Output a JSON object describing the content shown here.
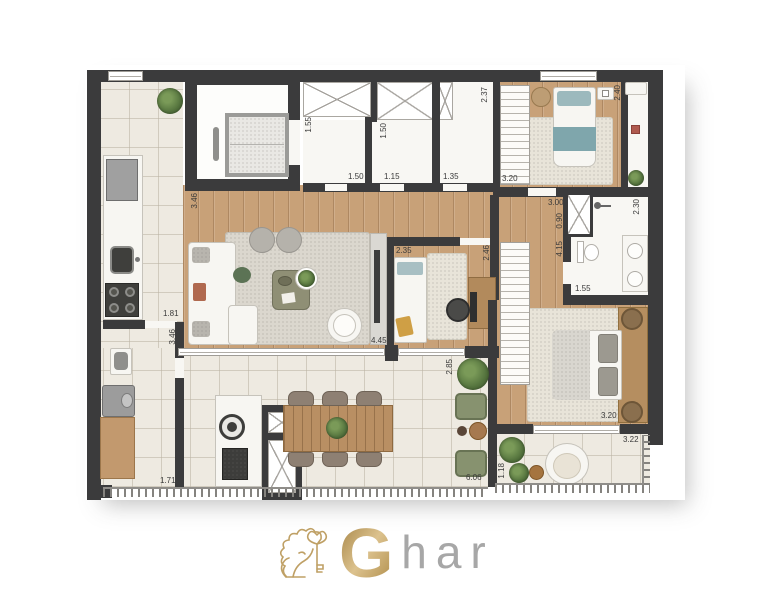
{
  "brand": {
    "g": "G",
    "suffix": "har"
  },
  "measurements": {
    "living_346": "3.46",
    "hall_346": "3.46",
    "kitchen_181": "1.81",
    "laundry_171": "1.71",
    "closet_155": "1.55",
    "closet_150": "1.50",
    "bath1_150": "1.50",
    "bath1_115": "1.15",
    "bath2_135": "1.35",
    "closet2_320": "3.20",
    "shaft_237": "2.37",
    "bed2_240": "2.40",
    "hall2_300": "3.00",
    "hall2_090": "0.90",
    "mbath_230": "2.30",
    "mbath_415": "4.15",
    "mbath_155": "1.55",
    "office_235": "2.35",
    "office_246": "2.46",
    "living_445": "4.45",
    "terrace_285": "2.85",
    "terrace_606": "6.06",
    "mbed_320": "3.20",
    "mbalc_322": "3.22",
    "mbalc_118": "1.18"
  }
}
